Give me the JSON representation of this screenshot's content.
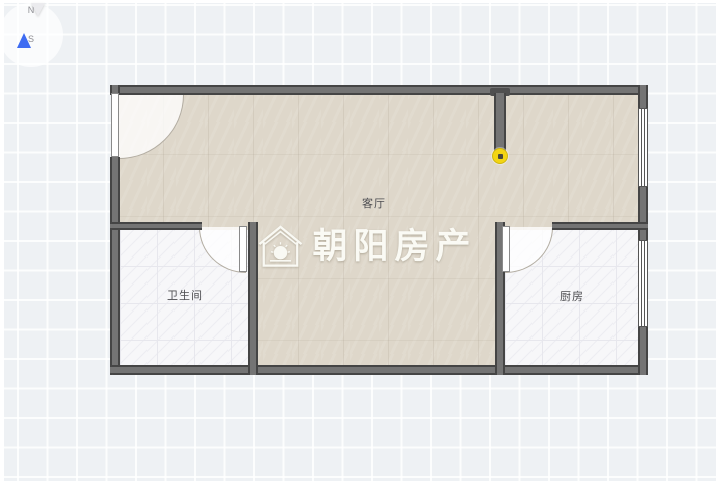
{
  "compass": {
    "north_label": "N",
    "south_label": "S"
  },
  "rooms": {
    "living_room": {
      "label": "客厅"
    },
    "bathroom": {
      "label": "卫生间"
    },
    "kitchen": {
      "label": "厨房"
    }
  },
  "watermark": {
    "brand": "朝阳房产"
  },
  "colors": {
    "canvas_bg": "#eef1f4",
    "wall": "#5f5f5f",
    "wall_edge": "#454545",
    "floor_living": "#ded7ca",
    "floor_tile": "#f7f7f9",
    "handle": "#f3d513",
    "compass_north": "#3e6cf2"
  }
}
